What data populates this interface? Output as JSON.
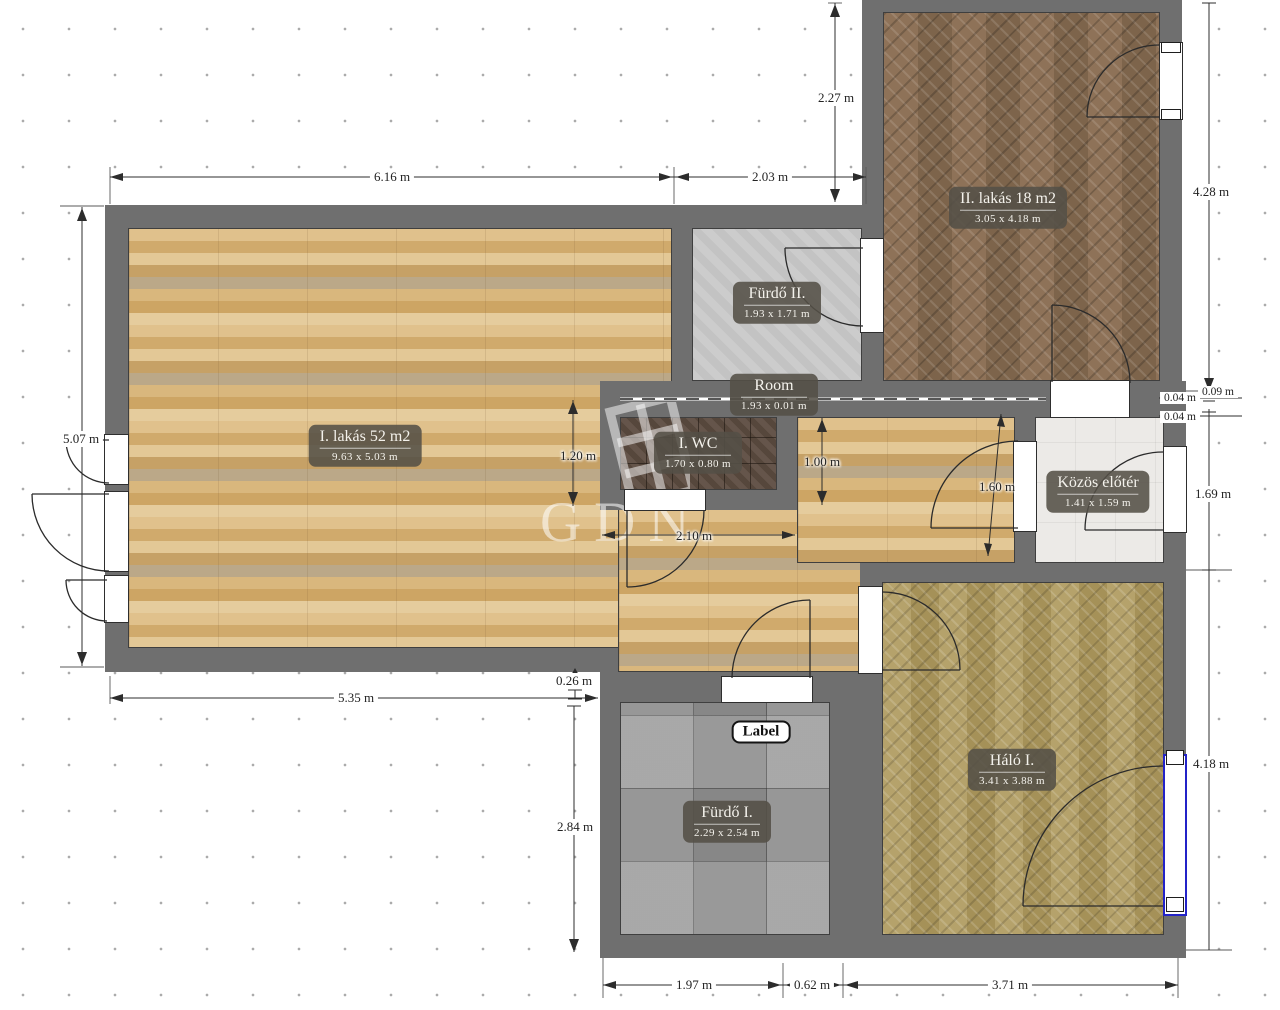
{
  "watermark": {
    "text": "GDN"
  },
  "label_badge": {
    "text": "Label"
  },
  "rooms": [
    {
      "id": "i-lakas",
      "name": "I. lakás 52 m2",
      "size": "9.63 x 5.03 m"
    },
    {
      "id": "ii-lakas",
      "name": "II. lakás 18 m2",
      "size": "3.05 x 4.18 m"
    },
    {
      "id": "furdo-ii",
      "name": "Fürdő II.",
      "size": "1.93 x 1.71 m"
    },
    {
      "id": "room",
      "name": "Room",
      "size": "1.93 x 0.01 m"
    },
    {
      "id": "i-wc",
      "name": "I. WC",
      "size": "1.70 x 0.80 m"
    },
    {
      "id": "kozos-eloter",
      "name": "Közös előtér",
      "size": "1.41 x 1.59 m"
    },
    {
      "id": "halo-i",
      "name": "Háló I.",
      "size": "3.41 x 3.88 m"
    },
    {
      "id": "furdo-i",
      "name": "Fürdő I.",
      "size": "2.29 x 2.54 m"
    }
  ],
  "dims": [
    {
      "text": "6.16 m"
    },
    {
      "text": "2.03 m"
    },
    {
      "text": "2.27 m"
    },
    {
      "text": "4.28 m"
    },
    {
      "text": "5.07 m"
    },
    {
      "text": "1.20 m"
    },
    {
      "text": "1.00 m"
    },
    {
      "text": "1.60 m"
    },
    {
      "text": "2.10 m"
    },
    {
      "text": "0.26 m"
    },
    {
      "text": "5.35 m"
    },
    {
      "text": "2.84 m"
    },
    {
      "text": "1.69 m"
    },
    {
      "text": "4.18 m"
    },
    {
      "text": "1.97 m"
    },
    {
      "text": "0.62 m"
    },
    {
      "text": "3.71 m"
    },
    {
      "text": "0.04 m"
    },
    {
      "text": "0.09 m"
    },
    {
      "text": "0.04 m"
    }
  ],
  "colors": {
    "wall": "#6f6f6f",
    "parquet_light": "#d6b47c",
    "parquet_dark": "#87694f",
    "parquet_olive": "#b19e67",
    "tile_gray": "#9d9d9d",
    "tile_wc": "#5d4c41",
    "bath_light": "#c9c9c9",
    "hall_white": "#eceae7",
    "selection_blue": "#2323c8",
    "dots": "#ababab"
  }
}
